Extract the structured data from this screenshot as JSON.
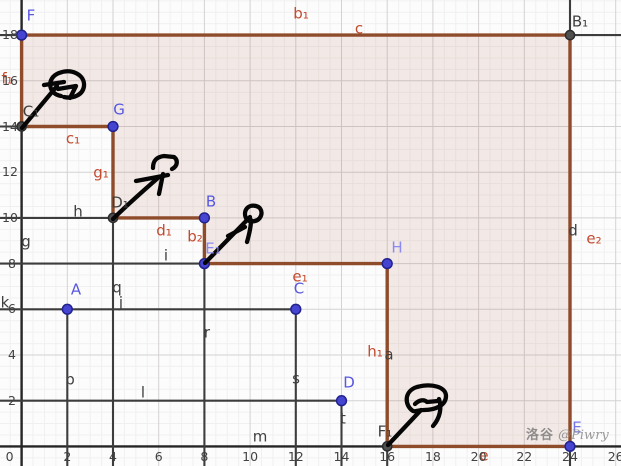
{
  "canvas": {
    "width": 621,
    "height": 466,
    "origin_x": 21.6,
    "origin_y": 446.4,
    "unit": 22.85
  },
  "colors": {
    "background": "#fcfcfc",
    "grid_minor": "#f1f0f0",
    "grid_major": "#d4d2d2",
    "axis": "#262626",
    "construction_line": "#3d3d3d",
    "polygon_edge": "#8f4c2b",
    "polygon_fill": "rgba(158,72,36,0.10)",
    "point_blue": "#4545d2",
    "point_blue_stroke": "#22228c",
    "point_gray": "#4f4f4f",
    "point_gray_stroke": "#2b2b2b",
    "label_blue": "#5757e0",
    "label_blue_light": "#8a8af2",
    "label_blue_mid": "#7575ea",
    "label_dark": "#3f3f3f",
    "label_red": "#c44a2e",
    "tick": "#424242",
    "ink": "#060606"
  },
  "polygon": {
    "name": "staircase-region",
    "vertices": [
      [
        0,
        18
      ],
      [
        24,
        18
      ],
      [
        24,
        0
      ],
      [
        16,
        0
      ],
      [
        16,
        8
      ],
      [
        8,
        8
      ],
      [
        8,
        10
      ],
      [
        4,
        10
      ],
      [
        4,
        14
      ],
      [
        0,
        14
      ]
    ]
  },
  "construction_segments": [
    {
      "id": "line-18-left",
      "from": [
        -1,
        18
      ],
      "to": [
        0,
        18
      ]
    },
    {
      "id": "line-18-right",
      "from": [
        24,
        18
      ],
      "to": [
        26.5,
        18
      ]
    },
    {
      "id": "line-14-left",
      "from": [
        -1,
        14
      ],
      "to": [
        0,
        14
      ]
    },
    {
      "id": "line-h",
      "from": [
        -1,
        10
      ],
      "to": [
        4,
        10
      ]
    },
    {
      "id": "line-i",
      "from": [
        -1,
        8
      ],
      "to": [
        8,
        8
      ]
    },
    {
      "id": "line-k",
      "from": [
        -1,
        6
      ],
      "to": [
        12,
        6
      ]
    },
    {
      "id": "line-l",
      "from": [
        -1,
        2
      ],
      "to": [
        14,
        2
      ]
    },
    {
      "id": "line-p",
      "from": [
        2,
        6
      ],
      "to": [
        2,
        -1
      ]
    },
    {
      "id": "line-q",
      "from": [
        4,
        10
      ],
      "to": [
        4,
        -1
      ]
    },
    {
      "id": "line-r",
      "from": [
        8,
        8
      ],
      "to": [
        8,
        -1
      ]
    },
    {
      "id": "line-s",
      "from": [
        12,
        6
      ],
      "to": [
        12,
        -1
      ]
    },
    {
      "id": "line-t",
      "from": [
        14,
        2
      ],
      "to": [
        14,
        -1
      ]
    },
    {
      "id": "line-a",
      "from": [
        16,
        8
      ],
      "to": [
        16,
        -1
      ]
    },
    {
      "id": "line-d",
      "from": [
        24,
        19.6
      ],
      "to": [
        24,
        -1
      ]
    }
  ],
  "points": [
    {
      "label": "F",
      "x": 0,
      "y": 18,
      "color": "blue"
    },
    {
      "label": "B₁",
      "x": 24,
      "y": 18,
      "color": "gray"
    },
    {
      "label": "C₁",
      "x": 0,
      "y": 14,
      "color": "gray"
    },
    {
      "label": "G",
      "x": 4,
      "y": 14,
      "color": "blue"
    },
    {
      "label": "D₁",
      "x": 4,
      "y": 10,
      "color": "gray"
    },
    {
      "label": "B",
      "x": 8,
      "y": 10,
      "color": "blue"
    },
    {
      "label": "E₁",
      "x": 8,
      "y": 8,
      "color": "blue"
    },
    {
      "label": "H",
      "x": 16,
      "y": 8,
      "color": "blue"
    },
    {
      "label": "A",
      "x": 2,
      "y": 6,
      "color": "blue"
    },
    {
      "label": "C",
      "x": 12,
      "y": 6,
      "color": "blue"
    },
    {
      "label": "D",
      "x": 14,
      "y": 2,
      "color": "blue"
    },
    {
      "label": "F₁",
      "x": 16,
      "y": 0,
      "color": "gray"
    },
    {
      "label": "E",
      "x": 24,
      "y": 0,
      "color": "blue"
    }
  ],
  "point_labels": [
    {
      "text": "F",
      "x": 31,
      "y": 16,
      "tone": "blue"
    },
    {
      "text": "B₁",
      "x": 580,
      "y": 22,
      "tone": "dark"
    },
    {
      "text": "C₁",
      "x": 31,
      "y": 112,
      "tone": "dark"
    },
    {
      "text": "G",
      "x": 119,
      "y": 110,
      "tone": "blue"
    },
    {
      "text": "D₁",
      "x": 120,
      "y": 203,
      "tone": "dark"
    },
    {
      "text": "B",
      "x": 211,
      "y": 202,
      "tone": "blue"
    },
    {
      "text": "E₁",
      "x": 213,
      "y": 249,
      "tone": "blue-light"
    },
    {
      "text": "H",
      "x": 397,
      "y": 248,
      "tone": "blue-light"
    },
    {
      "text": "A",
      "x": 76,
      "y": 290,
      "tone": "blue"
    },
    {
      "text": "C",
      "x": 299,
      "y": 289,
      "tone": "blue"
    },
    {
      "text": "D",
      "x": 349,
      "y": 383,
      "tone": "blue"
    },
    {
      "text": "F₁",
      "x": 385,
      "y": 432,
      "tone": "dark"
    },
    {
      "text": "E",
      "x": 577,
      "y": 428,
      "tone": "blue-mid"
    }
  ],
  "segment_labels": [
    {
      "text": "b₁",
      "x": 301,
      "y": 14
    },
    {
      "text": "c",
      "x": 359,
      "y": 29
    },
    {
      "text": "f₁",
      "x": 7,
      "y": 79
    },
    {
      "text": "c₁",
      "x": 73,
      "y": 139
    },
    {
      "text": "g₁",
      "x": 101,
      "y": 173
    },
    {
      "text": "d₁",
      "x": 164,
      "y": 231
    },
    {
      "text": "b₂",
      "x": 195,
      "y": 237
    },
    {
      "text": "e₁",
      "x": 300,
      "y": 277
    },
    {
      "text": "h₁",
      "x": 375,
      "y": 352
    },
    {
      "text": "e",
      "x": 484,
      "y": 456
    },
    {
      "text": "e₂",
      "x": 594,
      "y": 239
    }
  ],
  "line_labels": [
    {
      "text": "g",
      "x": 26,
      "y": 242
    },
    {
      "text": "h",
      "x": 78,
      "y": 212
    },
    {
      "text": "i",
      "x": 166,
      "y": 256
    },
    {
      "text": "k",
      "x": 5,
      "y": 303
    },
    {
      "text": "j",
      "x": 121,
      "y": 303
    },
    {
      "text": "q",
      "x": 117,
      "y": 288
    },
    {
      "text": "p",
      "x": 70,
      "y": 380
    },
    {
      "text": "r",
      "x": 207,
      "y": 333
    },
    {
      "text": "s",
      "x": 296,
      "y": 379
    },
    {
      "text": "l",
      "x": 143,
      "y": 393
    },
    {
      "text": "m",
      "x": 260,
      "y": 437
    },
    {
      "text": "t",
      "x": 343,
      "y": 419
    },
    {
      "text": "a",
      "x": 389,
      "y": 355
    },
    {
      "text": "d",
      "x": 573,
      "y": 231
    }
  ],
  "axis": {
    "x_values": [
      0,
      2,
      4,
      6,
      8,
      10,
      12,
      14,
      16,
      18,
      20,
      22,
      24,
      26
    ],
    "y_values": [
      2,
      4,
      6,
      8,
      10,
      12,
      14,
      16,
      18
    ]
  },
  "watermark": {
    "cjk": "洛谷",
    "latin": "@Piwry"
  }
}
